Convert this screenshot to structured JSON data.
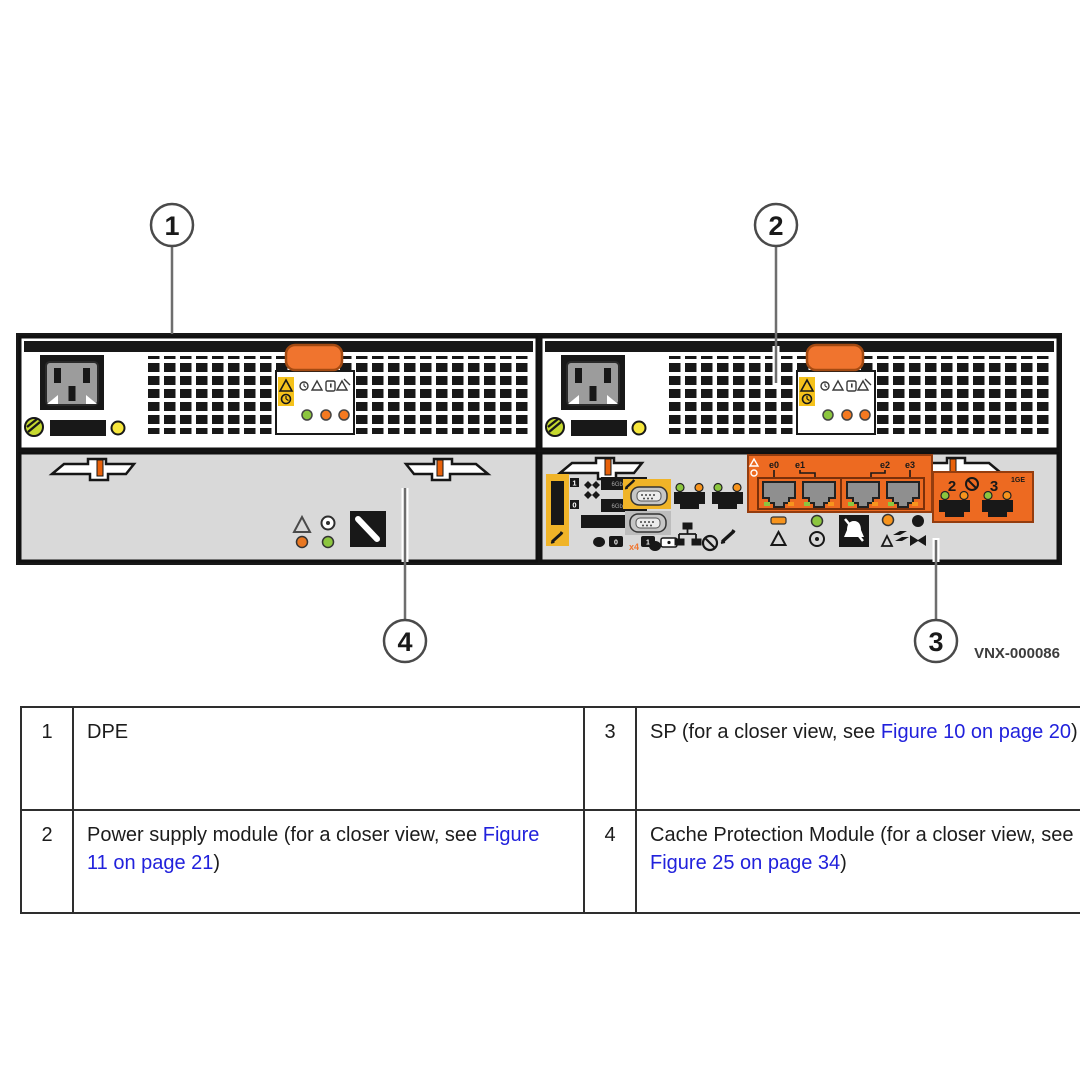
{
  "figure": {
    "id_label": "VNX-000086"
  },
  "callouts": {
    "c1": "1",
    "c2": "2",
    "c3": "3",
    "c4": "4"
  },
  "sp": {
    "eth_labels": {
      "e0": "e0",
      "e1": "e1",
      "e2": "e2",
      "e3": "e3"
    },
    "ge_ports": {
      "p2": "2",
      "p3": "3",
      "speed": "1GE"
    },
    "sas": {
      "port1": "1",
      "port0": "0",
      "speed_a": "6Gb SAS",
      "speed_b": "6Gb SAS",
      "lane": "x4",
      "conn0": "0",
      "conn1": "1"
    }
  },
  "colors": {
    "accent_orange": "#ED6A21",
    "latch_orange": "#F0742E",
    "label_yellow": "#F5C21B",
    "sas_yellow": "#F0B428",
    "led_green": "#8CC63E",
    "led_amber": "#F7941D",
    "led_yellow": "#F7E73C",
    "link_blue": "#2121DC",
    "panel_gray": "#D9D9D9"
  },
  "legend": {
    "rows": [
      {
        "num": "1",
        "prefix": "DPE",
        "link": "",
        "suffix": ""
      },
      {
        "num": "2",
        "prefix": "Power supply module (for a closer view, see ",
        "link": "Figure 11 on page 21",
        "suffix": ")"
      },
      {
        "num": "3",
        "prefix": "SP (for a closer view, see ",
        "link": "Figure 10 on page 20",
        "suffix": ")"
      },
      {
        "num": "4",
        "prefix": "Cache Protection Module (for a closer view, see ",
        "link": "Figure 25 on page 34",
        "suffix": ")"
      }
    ]
  }
}
